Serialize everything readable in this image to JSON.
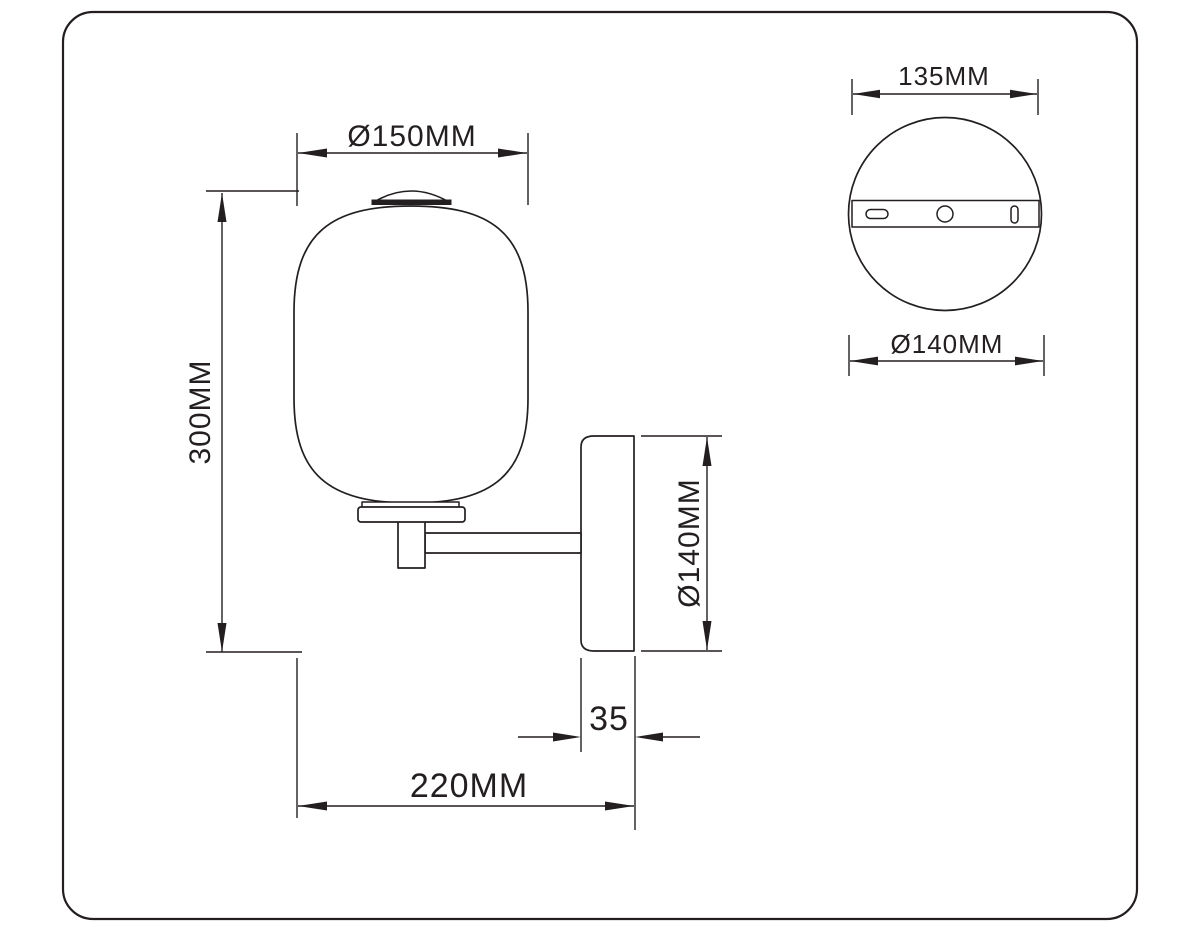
{
  "page": {
    "title": "Wall sconce technical dimension drawing",
    "background_color": "#ffffff",
    "line_color": "#231f20"
  },
  "front_view": {
    "name": "Front view of wall sconce with capsule glass shade",
    "dims": {
      "shade_diameter": "Ø150MM",
      "total_height": "300MM",
      "backplate_height": "Ø140MM",
      "backplate_depth": "35",
      "projection": "220MM"
    }
  },
  "top_view": {
    "name": "Rear view of round mounting backplate",
    "dims": {
      "bracket_width": "135MM",
      "backplate_diameter": "Ø140MM"
    }
  }
}
